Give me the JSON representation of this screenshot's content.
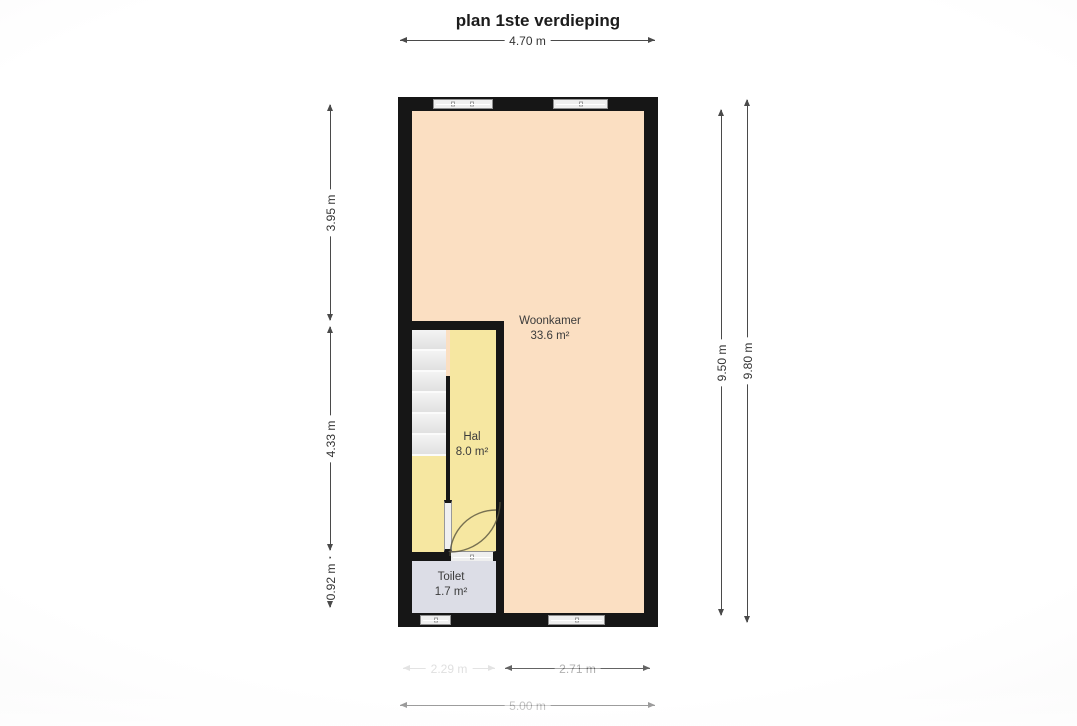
{
  "title": "plan 1ste verdieping",
  "rooms": [
    {
      "name": "Woonkamer",
      "area": "33.6 m²"
    },
    {
      "name": "Hal",
      "area": "8.0 m²"
    },
    {
      "name": "Toilet",
      "area": "1.7 m²"
    }
  ],
  "dimensions": {
    "top_width": "4.70 m",
    "left": [
      "3.95 m",
      "4.33 m",
      "0.92 m"
    ],
    "right_inner": "9.50 m",
    "right_outer": "9.80 m",
    "bottom_left": "2.29 m",
    "bottom_right": "2.71 m",
    "bottom_total": "5.00 m"
  },
  "colors": {
    "wall": "#161616",
    "woonkamer": "#fbdfc2",
    "hal": "#f6e7a1",
    "toilet": "#dcdde6",
    "dimline": "#4a4a4a",
    "text": "#333333"
  }
}
